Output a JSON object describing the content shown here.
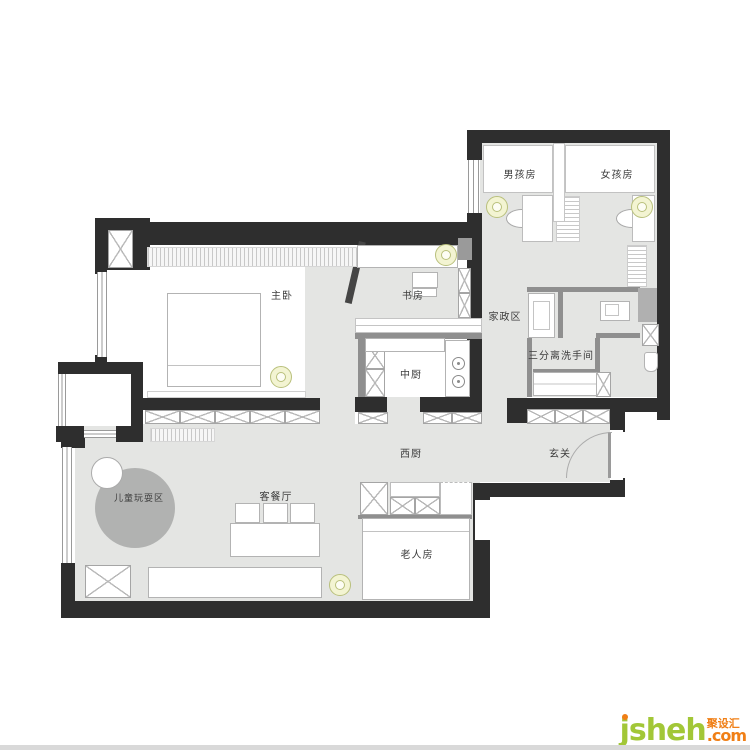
{
  "rooms": {
    "master_bedroom": {
      "label": "主卧"
    },
    "study": {
      "label": "书房"
    },
    "boys_room": {
      "label": "男孩房"
    },
    "girls_room": {
      "label": "女孩房"
    },
    "housekeeping": {
      "label": "家政区"
    },
    "bathroom": {
      "label": "三分离洗手间"
    },
    "chinese_kitchen": {
      "label": "中厨"
    },
    "western_kitchen": {
      "label": "西厨"
    },
    "entry": {
      "label": "玄关"
    },
    "living_dining": {
      "label": "客餐厅"
    },
    "kids_play": {
      "label": "儿童玩耍区"
    },
    "elder_room": {
      "label": "老人房"
    }
  },
  "watermark": {
    "brand": "jsheh",
    "tld": ".com",
    "cn": "聚设汇"
  },
  "colors": {
    "wall": "#2e2e2e",
    "partition_wall": "#8f8f8f",
    "floor": "#e4e5e3",
    "play_rug": "#b1b2b1",
    "ceiling_light": "#f3f4d2",
    "watermark_green": "#a2c737",
    "watermark_orange": "#f07f16"
  }
}
